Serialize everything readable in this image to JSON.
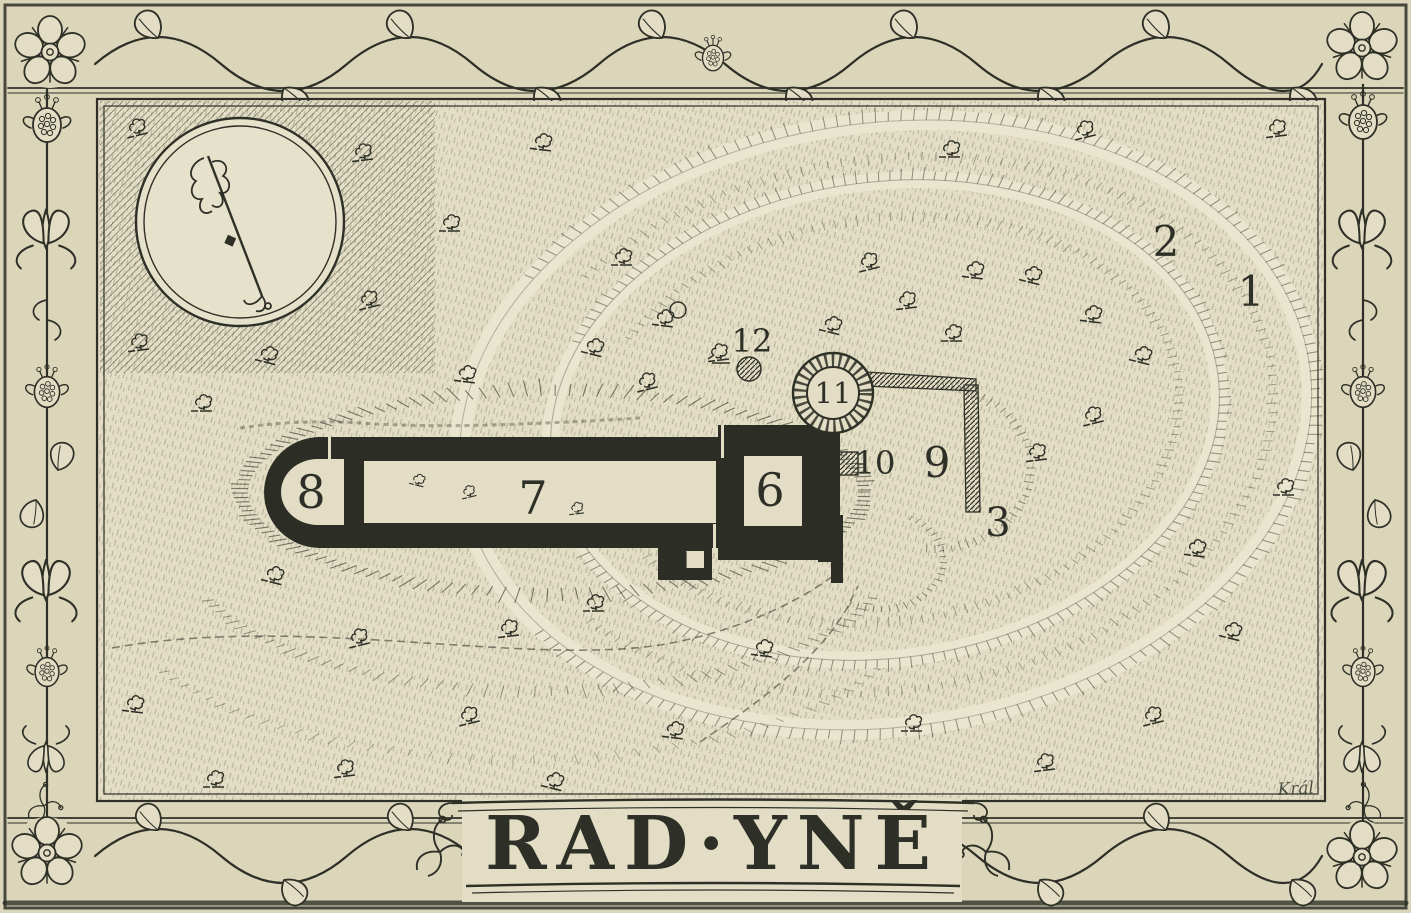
{
  "title": {
    "text": "RAD·YNĚ"
  },
  "signature": {
    "text": "Král"
  },
  "colors": {
    "paper": "#dbd6ba",
    "panel": "#e2ddc4",
    "paper_light": "#eae5cf",
    "ink": "#2e3027",
    "hatch": "#6b7258"
  },
  "icons": {
    "compass": "north-arrow-icon",
    "corner_flower": "rose-icon",
    "border_fruit": "pomegranate-icon",
    "border_flower": "lily-icon",
    "tree": "tree-icon"
  },
  "map_labels": [
    {
      "text": "1",
      "x": 1251,
      "y": 306,
      "size": 42
    },
    {
      "text": "2",
      "x": 1166,
      "y": 256,
      "size": 42
    },
    {
      "text": "3",
      "x": 998,
      "y": 536,
      "size": 40
    },
    {
      "text": "6",
      "x": 770,
      "y": 506,
      "size": 46
    },
    {
      "text": "7",
      "x": 533,
      "y": 514,
      "size": 46
    },
    {
      "text": "8",
      "x": 311,
      "y": 508,
      "size": 46
    },
    {
      "text": "9",
      "x": 937,
      "y": 477,
      "size": 42
    },
    {
      "text": "10",
      "x": 875,
      "y": 474,
      "size": 32
    },
    {
      "text": "11",
      "x": 833,
      "y": 403,
      "size": 29
    },
    {
      "text": "12",
      "x": 752,
      "y": 352,
      "size": 32
    }
  ],
  "trees": [
    [
      130,
      128
    ],
    [
      356,
      152
    ],
    [
      444,
      222
    ],
    [
      536,
      140
    ],
    [
      262,
      352
    ],
    [
      362,
      300
    ],
    [
      132,
      342
    ],
    [
      196,
      402
    ],
    [
      460,
      372
    ],
    [
      588,
      344
    ],
    [
      640,
      382
    ],
    [
      712,
      352
    ],
    [
      616,
      256
    ],
    [
      658,
      316
    ],
    [
      826,
      322
    ],
    [
      862,
      262
    ],
    [
      900,
      300
    ],
    [
      946,
      332
    ],
    [
      968,
      268
    ],
    [
      1026,
      272
    ],
    [
      1078,
      130
    ],
    [
      1270,
      128
    ],
    [
      944,
      148
    ],
    [
      1086,
      312
    ],
    [
      1136,
      352
    ],
    [
      1086,
      416
    ],
    [
      1030,
      452
    ],
    [
      1278,
      486
    ],
    [
      1190,
      546
    ],
    [
      1226,
      628
    ],
    [
      1146,
      716
    ],
    [
      1038,
      762
    ],
    [
      906,
      722
    ],
    [
      668,
      728
    ],
    [
      548,
      778
    ],
    [
      462,
      716
    ],
    [
      338,
      768
    ],
    [
      208,
      778
    ],
    [
      128,
      702
    ],
    [
      268,
      572
    ],
    [
      352,
      638
    ],
    [
      502,
      628
    ],
    [
      588,
      602
    ],
    [
      757,
      646
    ],
    [
      414,
      478,
      0.7
    ],
    [
      464,
      492,
      0.7
    ],
    [
      572,
      508,
      0.7
    ]
  ]
}
